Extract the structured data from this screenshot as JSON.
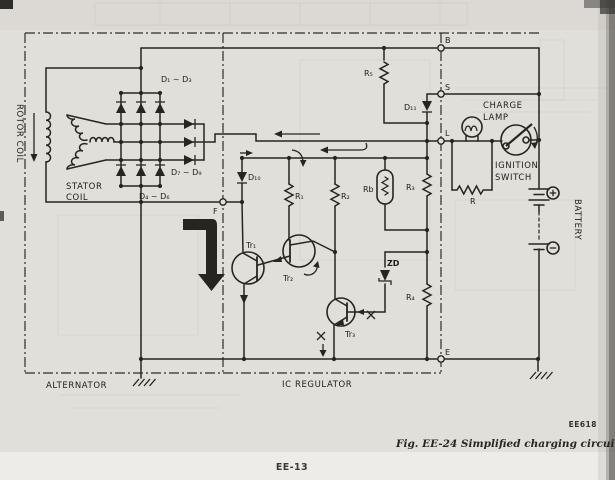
{
  "page": {
    "figure_code": "EE618",
    "caption": "Fig. EE-24  Simplified charging circuit (1)",
    "page_number": "EE-13"
  },
  "diagram": {
    "colors": {
      "ink": "#26251f",
      "paper": "#e1dfd9"
    },
    "sections": {
      "alternator": "ALTERNATOR",
      "ic_regulator": "IC REGULATOR"
    },
    "terminals": {
      "b": "B",
      "s": "S",
      "l": "L",
      "e": "E",
      "f": "F"
    },
    "labels": {
      "rotor_coil": "ROTOR COIL",
      "stator_line1": "STATOR",
      "stator_line2": "COIL",
      "d1d3": "D₁ ~ D₃",
      "d7d9": "D₇ ~ D₉",
      "d4d6": "D₄ ~ D₆",
      "d10": "D₁₀",
      "d11": "D₁₁",
      "r1": "R₁",
      "r2": "R₂",
      "r3": "R₃",
      "r4": "R₄",
      "r5": "R₅",
      "rb": "Rb",
      "r": "R",
      "zd": "ZD",
      "tr1": "Tr₁",
      "tr2": "Tr₂",
      "tr3": "Tr₃",
      "charge_lamp_line1": "CHARGE",
      "charge_lamp_line2": "LAMP",
      "ignition_line1": "IGNITION",
      "ignition_line2": "SWITCH",
      "battery": "BATTERY",
      "battery_plus": "+",
      "battery_minus": "−"
    }
  }
}
